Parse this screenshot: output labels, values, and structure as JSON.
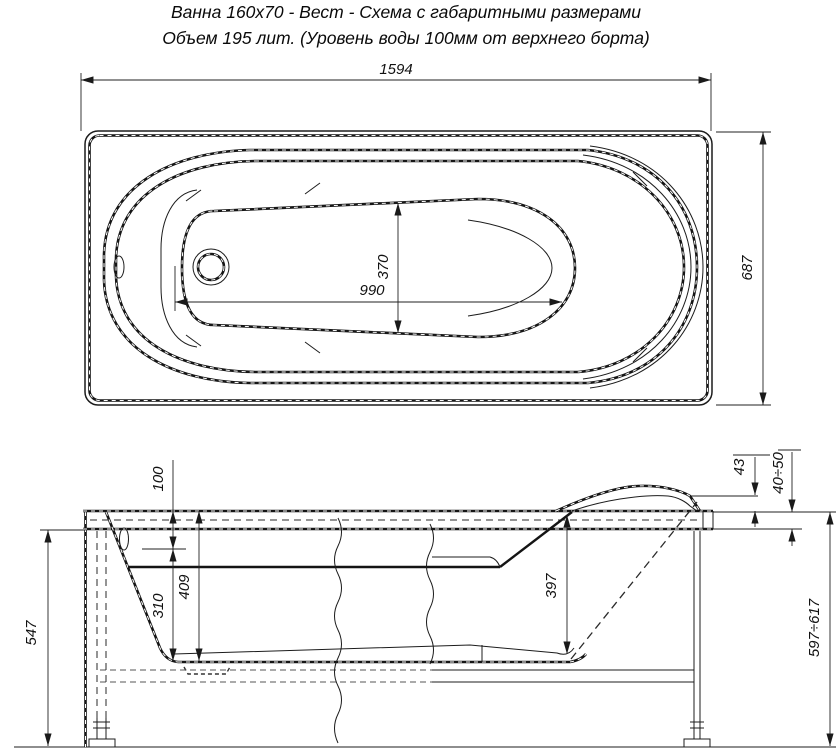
{
  "title": {
    "line1": "Ванна 160х70 - Вест - Схема с габаритными размерами",
    "line2": "Объем 195 лит. (Уровень воды 100мм от верхнего борта)"
  },
  "top_view": {
    "overall_length": "1594",
    "overall_width": "687",
    "bottom_length": "990",
    "bottom_width": "370"
  },
  "side_view": {
    "water_level": "100",
    "depth_below_water": "310",
    "depth_total": "409",
    "depth_rear": "397",
    "headrest_rise": "43",
    "rim_height": "40÷50",
    "height_under_rim": "547",
    "overall_height": "597÷617"
  }
}
